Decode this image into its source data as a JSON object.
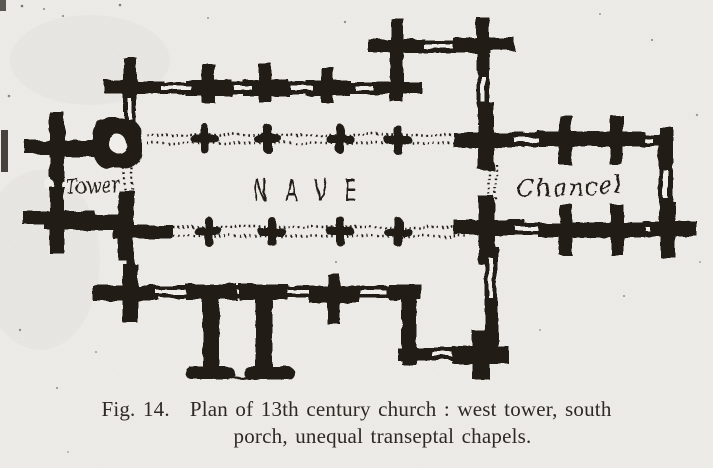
{
  "figure": {
    "caption": {
      "label": "Fig. 14.",
      "line1": "Plan of 13th century church : west tower, south",
      "line2": "porch, unequal transeptal chapels."
    },
    "plan_labels": {
      "tower": "Tower",
      "nave": "NAVE",
      "chancel": "Chancel"
    },
    "colors": {
      "ink": "#221d19",
      "paper": "#f0eeea",
      "caption_ink": "#2d2924"
    }
  }
}
